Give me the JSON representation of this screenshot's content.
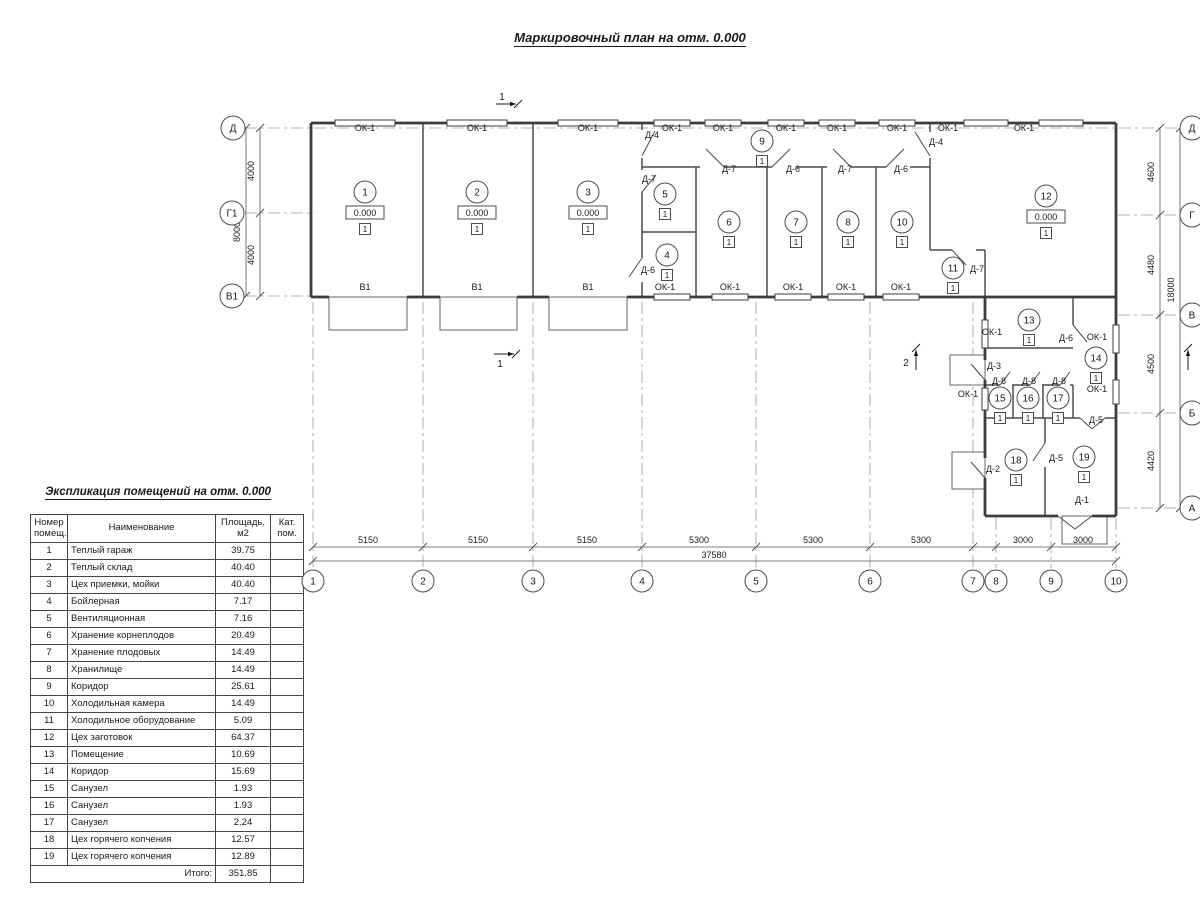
{
  "title": "Маркировочный план на отм. 0.000",
  "explication": {
    "title": "Экспликация помещений на отм. 0.000",
    "headers": [
      "Номер\nпомещ.",
      "Наименование",
      "Площадь,\nм2",
      "Кат.\nпом."
    ],
    "rows": [
      [
        "1",
        "Теплый гараж",
        "39.75",
        ""
      ],
      [
        "2",
        "Теплый склад",
        "40.40",
        ""
      ],
      [
        "3",
        "Цех приемки, мойки",
        "40.40",
        ""
      ],
      [
        "4",
        "Бойлерная",
        "7.17",
        ""
      ],
      [
        "5",
        "Вентиляционная",
        "7.16",
        ""
      ],
      [
        "6",
        "Хранение корнеплодов",
        "20.49",
        ""
      ],
      [
        "7",
        "Хранение плодовых",
        "14.49",
        ""
      ],
      [
        "8",
        "Хранилище",
        "14.49",
        ""
      ],
      [
        "9",
        "Коридор",
        "25.61",
        ""
      ],
      [
        "10",
        "Холодильная камера",
        "14.49",
        ""
      ],
      [
        "11",
        "Холодильное оборудование",
        "5.09",
        ""
      ],
      [
        "12",
        "Цех заготовок",
        "64.37",
        ""
      ],
      [
        "13",
        "Помещение",
        "10.69",
        ""
      ],
      [
        "14",
        "Коридор",
        "15.69",
        ""
      ],
      [
        "15",
        "Санузел",
        "1.93",
        ""
      ],
      [
        "16",
        "Санузел",
        "1.93",
        ""
      ],
      [
        "17",
        "Санузел",
        "2.24",
        ""
      ],
      [
        "18",
        "Цех горячего копчения",
        "12.57",
        ""
      ],
      [
        "19",
        "Цех горячего копчения",
        "12.89",
        ""
      ]
    ],
    "total_label": "Итого:",
    "total_value": "351.85"
  },
  "plan": {
    "elev_value": "0.000",
    "floor_mark": "1",
    "rooms": [
      {
        "n": "1",
        "x": 365,
        "y": 192,
        "e": true
      },
      {
        "n": "2",
        "x": 477,
        "y": 192,
        "e": true
      },
      {
        "n": "3",
        "x": 588,
        "y": 192,
        "e": true
      },
      {
        "n": "4",
        "x": 667,
        "y": 255
      },
      {
        "n": "5",
        "x": 665,
        "y": 194
      },
      {
        "n": "6",
        "x": 729,
        "y": 222
      },
      {
        "n": "7",
        "x": 796,
        "y": 222
      },
      {
        "n": "8",
        "x": 848,
        "y": 222
      },
      {
        "n": "9",
        "x": 762,
        "y": 141
      },
      {
        "n": "10",
        "x": 902,
        "y": 222
      },
      {
        "n": "11",
        "x": 953,
        "y": 268
      },
      {
        "n": "12",
        "x": 1046,
        "y": 196,
        "e": true
      },
      {
        "n": "13",
        "x": 1029,
        "y": 320
      },
      {
        "n": "14",
        "x": 1096,
        "y": 358
      },
      {
        "n": "15",
        "x": 1000,
        "y": 398
      },
      {
        "n": "16",
        "x": 1028,
        "y": 398
      },
      {
        "n": "17",
        "x": 1058,
        "y": 398
      },
      {
        "n": "18",
        "x": 1016,
        "y": 460
      },
      {
        "n": "19",
        "x": 1084,
        "y": 457
      }
    ],
    "labels": [
      [
        "ОК-1",
        365,
        131
      ],
      [
        "ОК-1",
        477,
        131
      ],
      [
        "ОК-1",
        588,
        131
      ],
      [
        "ОК-1",
        672,
        131
      ],
      [
        "ОК-1",
        723,
        131
      ],
      [
        "ОК-1",
        786,
        131
      ],
      [
        "ОК-1",
        837,
        131
      ],
      [
        "ОК-1",
        897,
        131
      ],
      [
        "ОК-1",
        948,
        131
      ],
      [
        "ОК-1",
        1024,
        131
      ],
      [
        "ОК-1",
        665,
        290
      ],
      [
        "ОК-1",
        730,
        290
      ],
      [
        "ОК-1",
        793,
        290
      ],
      [
        "ОК-1",
        846,
        290
      ],
      [
        "ОК-1",
        901,
        290
      ],
      [
        "ОК-1",
        992,
        335
      ],
      [
        "ОК-1",
        968,
        397
      ],
      [
        "ОК-1",
        1097,
        340
      ],
      [
        "ОК-1",
        1097,
        392
      ],
      [
        "В1",
        365,
        290
      ],
      [
        "В1",
        477,
        290
      ],
      [
        "В1",
        588,
        290
      ],
      [
        "Д-4",
        652,
        138
      ],
      [
        "Д-4",
        936,
        145
      ],
      [
        "Д-7",
        649,
        182
      ],
      [
        "Д-7",
        729,
        172
      ],
      [
        "Д-6",
        793,
        172
      ],
      [
        "Д-7",
        845,
        172
      ],
      [
        "Д-6",
        901,
        172
      ],
      [
        "Д-6",
        648,
        273
      ],
      [
        "Д-7",
        977,
        272
      ],
      [
        "Д-6",
        1066,
        341
      ],
      [
        "Д-3",
        994,
        369
      ],
      [
        "Д-8",
        999,
        384
      ],
      [
        "Д-8",
        1029,
        384
      ],
      [
        "Д-8",
        1059,
        384
      ],
      [
        "Д-5",
        1096,
        423
      ],
      [
        "Д-5",
        1056,
        461
      ],
      [
        "Д-2",
        993,
        472
      ],
      [
        "Д-1",
        1082,
        503
      ]
    ],
    "axis_bubbles": {
      "left": [
        [
          "Д",
          233,
          128
        ],
        [
          "Г1",
          232,
          213
        ],
        [
          "В1",
          232,
          296
        ]
      ],
      "right": [
        [
          "Д",
          1192,
          128
        ],
        [
          "Г",
          1192,
          215
        ],
        [
          "В",
          1192,
          315
        ],
        [
          "Б",
          1192,
          413
        ],
        [
          "А",
          1192,
          508
        ]
      ],
      "bottom": [
        [
          "1",
          313,
          581
        ],
        [
          "2",
          423,
          581
        ],
        [
          "3",
          533,
          581
        ],
        [
          "4",
          642,
          581
        ],
        [
          "5",
          756,
          581
        ],
        [
          "6",
          870,
          581
        ],
        [
          "7",
          973,
          581
        ],
        [
          "8",
          996,
          581
        ],
        [
          "9",
          1051,
          581
        ],
        [
          "10",
          1116,
          581
        ]
      ]
    },
    "dim_labels_h": [
      [
        "5150",
        368,
        543
      ],
      [
        "5150",
        478,
        543
      ],
      [
        "5150",
        587,
        543
      ],
      [
        "5300",
        699,
        543
      ],
      [
        "5300",
        813,
        543
      ],
      [
        "5300",
        921,
        543
      ],
      [
        "3000",
        1023,
        543
      ],
      [
        "3000",
        1083,
        543
      ],
      [
        "37580",
        714,
        558
      ]
    ],
    "dim_labels_v": [
      [
        "4000",
        254,
        171
      ],
      [
        "4000",
        254,
        255
      ],
      [
        "8000",
        240,
        232
      ],
      [
        "4600",
        1154,
        172
      ],
      [
        "4480",
        1154,
        265
      ],
      [
        "4500",
        1154,
        364
      ],
      [
        "4420",
        1154,
        461
      ],
      [
        "18000",
        1174,
        290
      ]
    ],
    "section_marks": [
      {
        "t": "1",
        "tx": 502,
        "ty": 100,
        "a": [
          496,
          104,
          516,
          104
        ]
      },
      {
        "t": "1",
        "tx": 500,
        "ty": 367,
        "a": [
          494,
          354,
          514,
          354
        ]
      },
      {
        "t": "2",
        "tx": 906,
        "ty": 366,
        "a": [
          916,
          370,
          916,
          350
        ]
      },
      {
        "t": "",
        "tx": 0,
        "ty": 0,
        "a": [
          1188,
          370,
          1188,
          350
        ]
      }
    ],
    "geometry": {
      "walls_outer": [
        [
          311,
          123,
          1116,
          123
        ],
        [
          311,
          123,
          311,
          297
        ],
        [
          1116,
          123,
          1116,
          516
        ],
        [
          985,
          516,
          1058,
          516
        ],
        [
          1092,
          516,
          1116,
          516
        ],
        [
          985,
          297,
          985,
          360
        ],
        [
          985,
          380,
          985,
          458
        ],
        [
          985,
          478,
          985,
          516
        ],
        [
          311,
          297,
          329,
          297
        ],
        [
          407,
          297,
          440,
          297
        ],
        [
          517,
          297,
          549,
          297
        ],
        [
          627,
          297,
          1116,
          297
        ]
      ],
      "walls_inner": [
        [
          423,
          123,
          423,
          297
        ],
        [
          533,
          123,
          533,
          297
        ],
        [
          642,
          123,
          642,
          130
        ],
        [
          642,
          158,
          642,
          170
        ],
        [
          642,
          192,
          642,
          258
        ],
        [
          642,
          282,
          642,
          297
        ],
        [
          696,
          167,
          696,
          297
        ],
        [
          767,
          167,
          767,
          297
        ],
        [
          822,
          167,
          822,
          297
        ],
        [
          876,
          167,
          876,
          297
        ],
        [
          930,
          123,
          930,
          132
        ],
        [
          930,
          158,
          930,
          250
        ],
        [
          642,
          167,
          700,
          167
        ],
        [
          724,
          167,
          772,
          167
        ],
        [
          796,
          167,
          827,
          167
        ],
        [
          851,
          167,
          886,
          167
        ],
        [
          910,
          167,
          930,
          167
        ],
        [
          642,
          232,
          696,
          232
        ],
        [
          930,
          250,
          952,
          250
        ],
        [
          976,
          250,
          985,
          250
        ],
        [
          985,
          250,
          985,
          297
        ],
        [
          985,
          348,
          1073,
          348
        ],
        [
          1073,
          297,
          1073,
          325
        ],
        [
          985,
          385,
          1000,
          385
        ],
        [
          1012,
          385,
          1030,
          385
        ],
        [
          1042,
          385,
          1060,
          385
        ],
        [
          1070,
          385,
          1073,
          385
        ],
        [
          1013,
          385,
          1013,
          418
        ],
        [
          1043,
          385,
          1043,
          418
        ],
        [
          1073,
          385,
          1073,
          418
        ],
        [
          985,
          418,
          1080,
          418
        ],
        [
          1105,
          418,
          1116,
          418
        ],
        [
          1045,
          418,
          1045,
          443
        ],
        [
          1045,
          467,
          1045,
          516
        ]
      ],
      "sills": [
        [
          329,
          297,
          407,
          297
        ],
        [
          440,
          297,
          517,
          297
        ],
        [
          549,
          297,
          627,
          297
        ]
      ],
      "windows": [
        {
          "o": "h",
          "x": 365,
          "y": 123,
          "l": 60
        },
        {
          "o": "h",
          "x": 477,
          "y": 123,
          "l": 60
        },
        {
          "o": "h",
          "x": 588,
          "y": 123,
          "l": 60
        },
        {
          "o": "h",
          "x": 672,
          "y": 123,
          "l": 36
        },
        {
          "o": "h",
          "x": 723,
          "y": 123,
          "l": 36
        },
        {
          "o": "h",
          "x": 786,
          "y": 123,
          "l": 36
        },
        {
          "o": "h",
          "x": 837,
          "y": 123,
          "l": 36
        },
        {
          "o": "h",
          "x": 897,
          "y": 123,
          "l": 36
        },
        {
          "o": "h",
          "x": 986,
          "y": 123,
          "l": 44
        },
        {
          "o": "h",
          "x": 1061,
          "y": 123,
          "l": 44
        },
        {
          "o": "h",
          "x": 672,
          "y": 297,
          "l": 36
        },
        {
          "o": "h",
          "x": 730,
          "y": 297,
          "l": 36
        },
        {
          "o": "h",
          "x": 793,
          "y": 297,
          "l": 36
        },
        {
          "o": "h",
          "x": 846,
          "y": 297,
          "l": 36
        },
        {
          "o": "h",
          "x": 901,
          "y": 297,
          "l": 36
        },
        {
          "o": "v",
          "x": 985,
          "y": 334,
          "l": 28
        },
        {
          "o": "v",
          "x": 985,
          "y": 399,
          "l": 22
        },
        {
          "o": "v",
          "x": 1116,
          "y": 339,
          "l": 28
        },
        {
          "o": "v",
          "x": 1116,
          "y": 392,
          "l": 24
        }
      ],
      "doors": [
        [
          642,
          156,
          655,
          131
        ],
        [
          930,
          156,
          915,
          132
        ],
        [
          724,
          167,
          706,
          149
        ],
        [
          772,
          167,
          790,
          149
        ],
        [
          851,
          167,
          833,
          149
        ],
        [
          886,
          167,
          904,
          149
        ],
        [
          642,
          192,
          656,
          175
        ],
        [
          642,
          258,
          629,
          277
        ],
        [
          952,
          250,
          966,
          265
        ],
        [
          1073,
          325,
          1087,
          342
        ],
        [
          1000,
          385,
          1010,
          372
        ],
        [
          1030,
          385,
          1040,
          372
        ],
        [
          1060,
          385,
          1070,
          372
        ],
        [
          985,
          380,
          971,
          364
        ],
        [
          985,
          478,
          971,
          462
        ],
        [
          1045,
          443,
          1033,
          461
        ],
        [
          1080,
          418,
          1092,
          429
        ],
        [
          1105,
          418,
          1092,
          429
        ],
        [
          1058,
          516,
          1075,
          529
        ],
        [
          1092,
          516,
          1075,
          529
        ]
      ],
      "aprons": [
        [
          329,
          297,
          78,
          33
        ],
        [
          440,
          297,
          77,
          33
        ],
        [
          549,
          297,
          78,
          33
        ],
        [
          950,
          355,
          35,
          30
        ],
        [
          952,
          452,
          33,
          37
        ],
        [
          1062,
          516,
          45,
          28
        ]
      ],
      "grid_v": [
        [
          313,
          302,
          568
        ],
        [
          423,
          302,
          568
        ],
        [
          533,
          302,
          568
        ],
        [
          642,
          302,
          568
        ],
        [
          756,
          302,
          568
        ],
        [
          870,
          302,
          568
        ],
        [
          973,
          302,
          568
        ],
        [
          996,
          518,
          568
        ],
        [
          1051,
          518,
          568
        ],
        [
          1116,
          518,
          568
        ]
      ],
      "grid_h": [
        [
          245,
          1180,
          128
        ],
        [
          245,
          315,
          213
        ],
        [
          245,
          322,
          296
        ],
        [
          1118,
          1180,
          215
        ],
        [
          1118,
          1180,
          315
        ],
        [
          1118,
          1180,
          413
        ],
        [
          1118,
          1180,
          508
        ]
      ],
      "dim_lines": [
        [
          246,
          128,
          246,
          296
        ],
        [
          260,
          128,
          260,
          296
        ],
        [
          1160,
          128,
          1160,
          508
        ],
        [
          1180,
          128,
          1180,
          508
        ],
        [
          313,
          547,
          1116,
          547
        ],
        [
          313,
          561,
          1116,
          561
        ]
      ],
      "dim_ticks": [
        [
          246,
          128
        ],
        [
          246,
          296
        ],
        [
          260,
          128
        ],
        [
          260,
          213
        ],
        [
          260,
          296
        ],
        [
          1160,
          128
        ],
        [
          1160,
          215
        ],
        [
          1160,
          315
        ],
        [
          1160,
          413
        ],
        [
          1160,
          508
        ],
        [
          1180,
          128
        ],
        [
          1180,
          508
        ],
        [
          313,
          547
        ],
        [
          423,
          547
        ],
        [
          533,
          547
        ],
        [
          642,
          547
        ],
        [
          756,
          547
        ],
        [
          870,
          547
        ],
        [
          973,
          547
        ],
        [
          996,
          547
        ],
        [
          1051,
          547
        ],
        [
          1116,
          547
        ],
        [
          313,
          561
        ],
        [
          1116,
          561
        ]
      ]
    }
  },
  "colors": {
    "wall": "#3c3c3c",
    "inner": "#4c4c4c",
    "thin": "#666666",
    "dash": "#9a9a9a",
    "dim": "#555555",
    "text": "#1a1a1a"
  }
}
